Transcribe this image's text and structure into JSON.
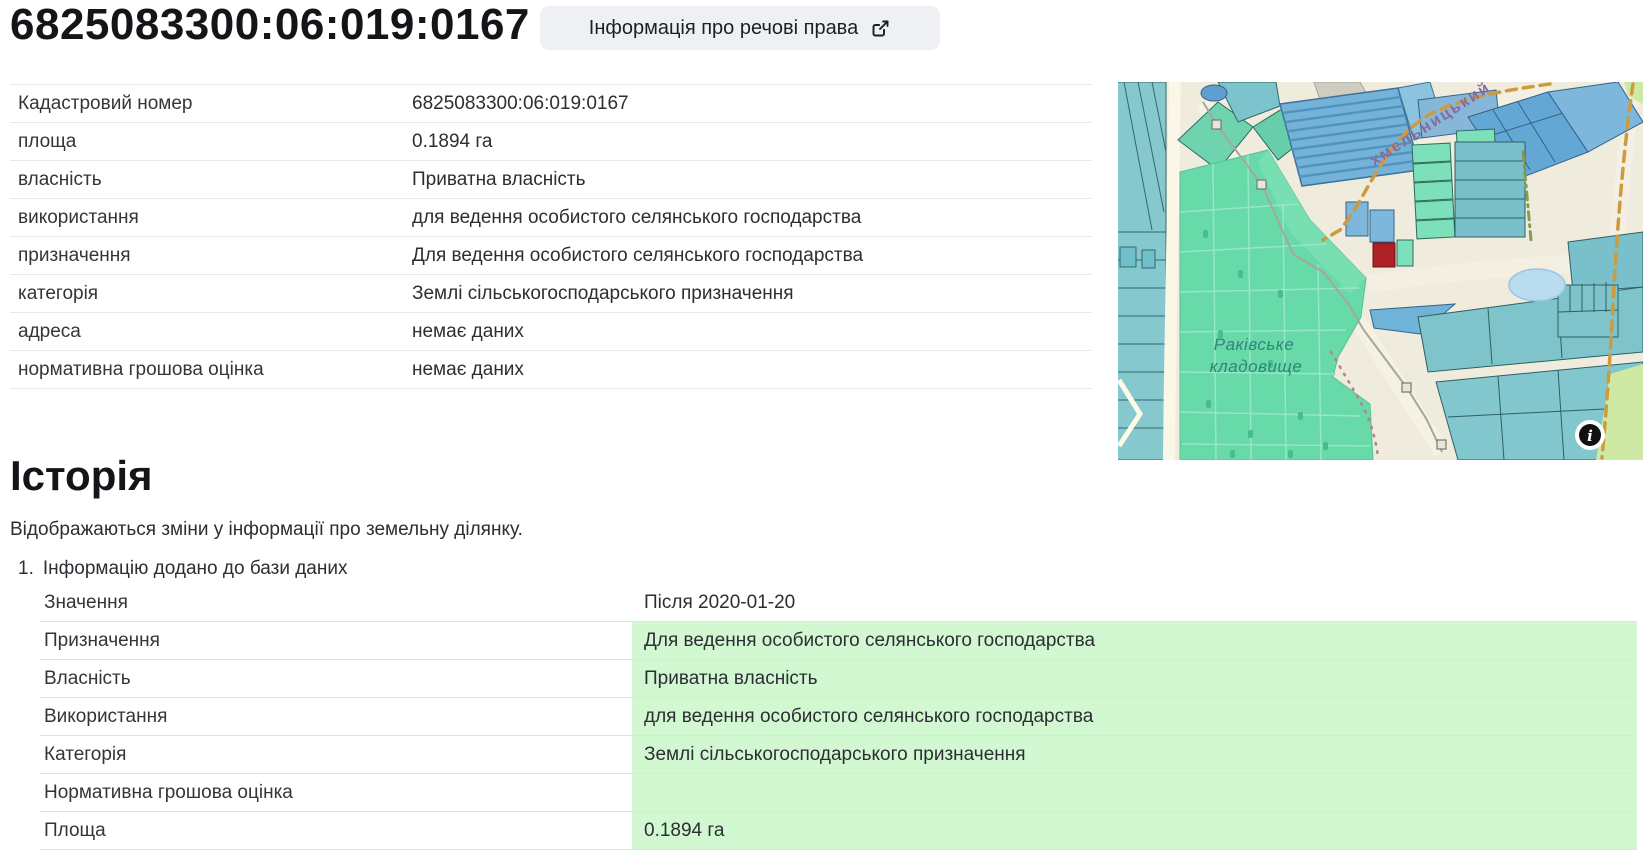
{
  "header": {
    "title": "6825083300:06:019:0167",
    "rights_button_label": "Інформація про речові права"
  },
  "details_table": {
    "rows": [
      {
        "label": "Кадастровий номер",
        "value": "6825083300:06:019:0167"
      },
      {
        "label": "площа",
        "value": "0.1894 га"
      },
      {
        "label": "власність",
        "value": "Приватна власність"
      },
      {
        "label": "використання",
        "value": "для ведення особистого селянського господарства"
      },
      {
        "label": "призначення",
        "value": "Для ведення особистого селянського господарства"
      },
      {
        "label": "категорія",
        "value": "Землі сільськогосподарського призначення"
      },
      {
        "label": "адреса",
        "value": "немає даних"
      },
      {
        "label": "нормативна грошова оцінка",
        "value": "немає даних"
      }
    ]
  },
  "map": {
    "cemetery_label_line1": "Раківське",
    "cemetery_label_line2": "кладовище",
    "street_label": "хмельницький",
    "info_icon_glyph": "i",
    "selected_parcel_color": "#ad2024"
  },
  "history": {
    "heading": "Історія",
    "description": "Відображаються зміни у інформації про земельну ділянку.",
    "entry_number": "1.",
    "entry_title": "Інформацію додано до бази даних",
    "rows": [
      {
        "label": "Значення",
        "value": "Після 2020-01-20"
      },
      {
        "label": "Призначення",
        "value": "Для ведення особистого селянського господарства"
      },
      {
        "label": "Власність",
        "value": "Приватна власність"
      },
      {
        "label": "Використання",
        "value": "для ведення особистого селянського господарства"
      },
      {
        "label": "Категорія",
        "value": "Землі сільськогосподарського призначення"
      },
      {
        "label": "Нормативна грошова оцінка",
        "value": ""
      },
      {
        "label": "Площа",
        "value": "0.1894 га"
      }
    ]
  },
  "colors": {
    "highlight_green": "#d2f8d2",
    "button_bg": "#eef0f3",
    "selected_parcel_red": "#ad2024"
  }
}
